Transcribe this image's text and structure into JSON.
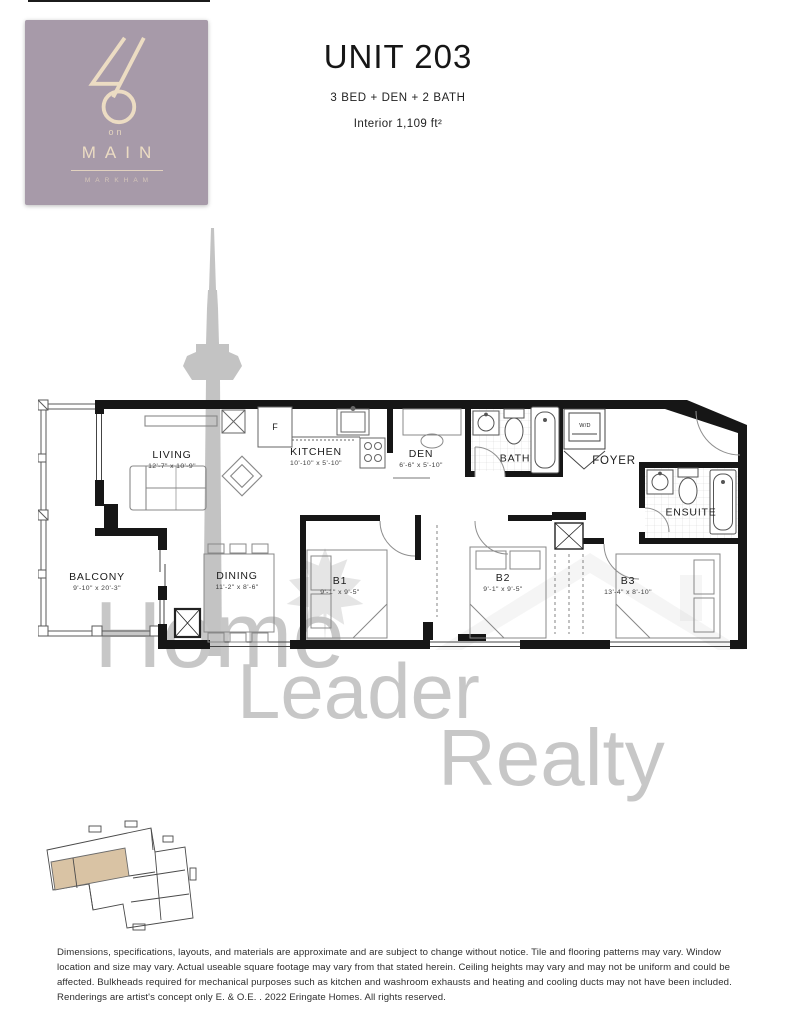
{
  "brand": {
    "logo_number": "46",
    "logo_on": "on",
    "logo_name": "MAIN",
    "logo_sub": "MARKHAM",
    "bg_color": "#a79aa9",
    "fg_color": "#ecdcc3"
  },
  "unit": {
    "title": "UNIT 203",
    "config": "3 BED + DEN + 2 BATH",
    "area": "Interior 1,109 ft²"
  },
  "floorplan": {
    "rooms": [
      {
        "id": "living",
        "name": "LIVING",
        "dims": "12'-7\" x 10'-9\""
      },
      {
        "id": "kitchen",
        "name": "KITCHEN",
        "dims": "10'-10\" x 5'-10\""
      },
      {
        "id": "den",
        "name": "DEN",
        "dims": "6'-6\" x 5'-10\""
      },
      {
        "id": "bath",
        "name": "BATH",
        "dims": ""
      },
      {
        "id": "foyer",
        "name": "FOYER",
        "dims": ""
      },
      {
        "id": "ensuite",
        "name": "ENSUITE",
        "dims": ""
      },
      {
        "id": "balcony",
        "name": "BALCONY",
        "dims": "9'-10\" x 20'-3\""
      },
      {
        "id": "dining",
        "name": "DINING",
        "dims": "11'-2\" x 8'-6\""
      },
      {
        "id": "b1",
        "name": "B1",
        "dims": "9'-1\" x 9'-5\""
      },
      {
        "id": "b2",
        "name": "B2",
        "dims": "9'-1\" x 9'-5\""
      },
      {
        "id": "b3",
        "name": "B3",
        "dims": "13'-4\" x 8'-10\""
      }
    ],
    "fixtures": {
      "fridge": "F",
      "washer_dryer": "W/D"
    }
  },
  "watermark": {
    "lines": [
      "Home",
      "Leader",
      "Realty"
    ],
    "color": "#c7c7c7"
  },
  "keyplan": {
    "highlight_color": "#d9c3a4"
  },
  "disclaimer": "Dimensions, specifications, layouts, and materials are approximate and are subject to change without notice. Tile and flooring patterns may vary. Window location and size may vary. Actual useable square footage may vary from that stated herein. Ceiling heights may vary and may not be uniform and could be affected. Bulkheads required for mechanical purposes such as kitchen and washroom exhausts and heating and cooling ducts may not have been included. Renderings are artist's concept only E. & O.E. . 2022 Eringate Homes. All rights reserved."
}
